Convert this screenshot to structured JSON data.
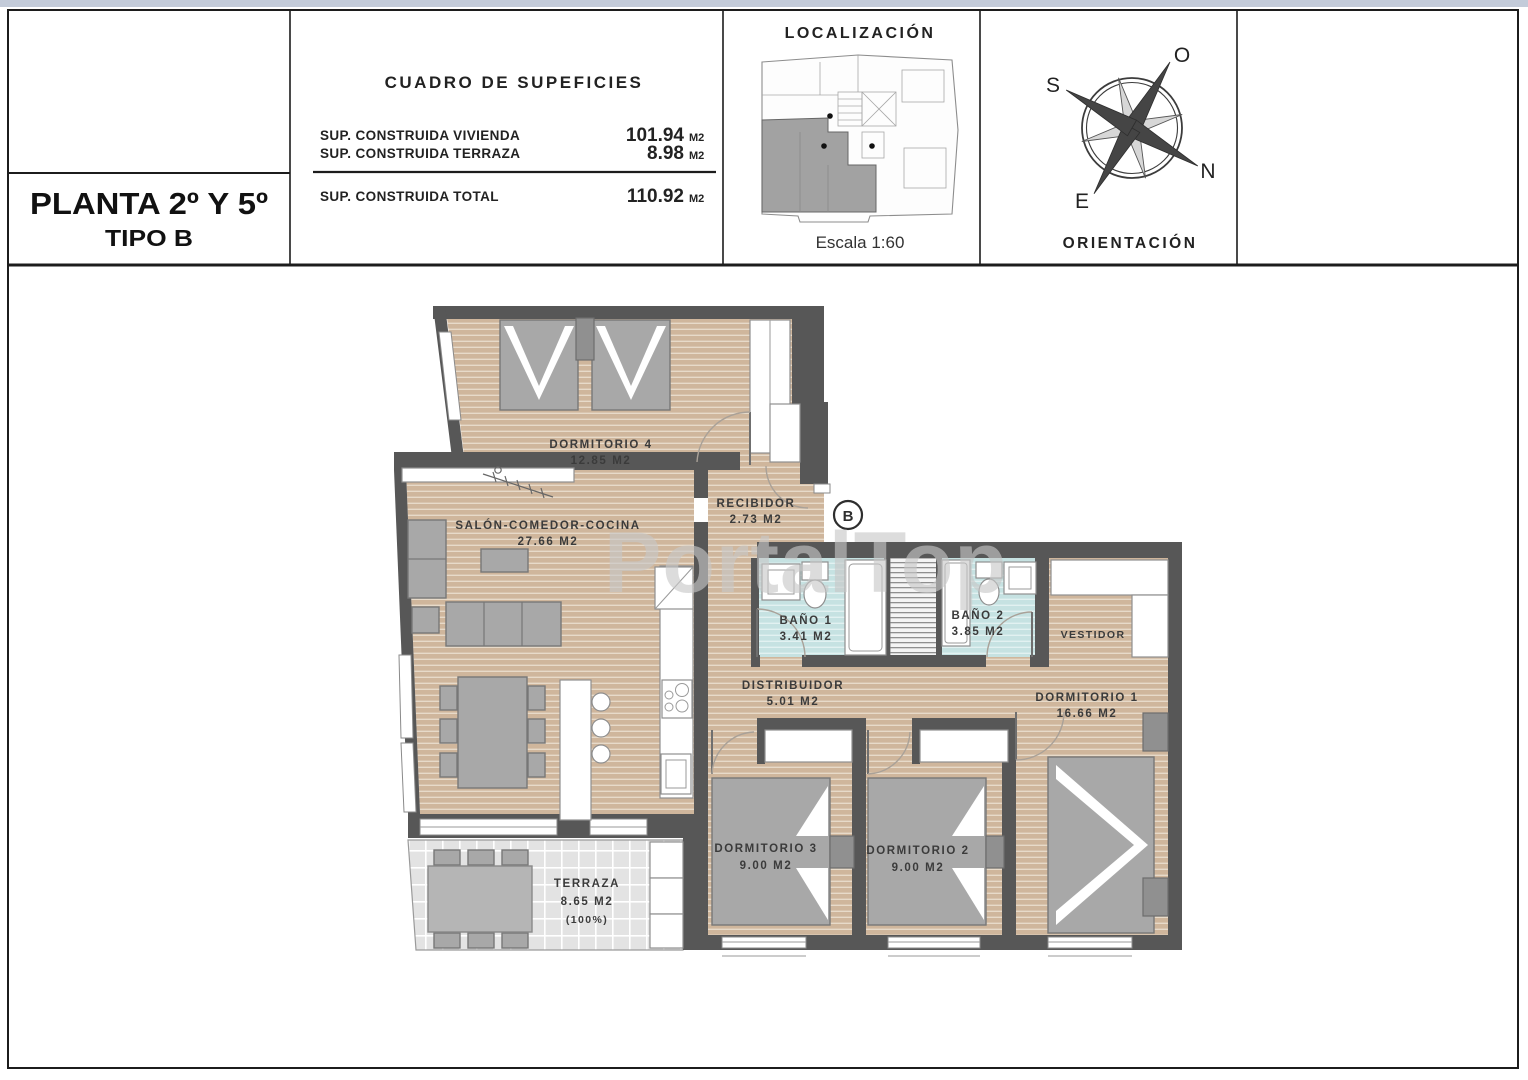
{
  "title_block": {
    "line1": "PLANTA 2º Y 5º",
    "line2": "TIPO B"
  },
  "surface_table": {
    "title": "CUADRO DE SUPEFICIES",
    "rows": [
      {
        "label": "SUP. CONSTRUIDA VIVIENDA",
        "value": "101.94",
        "unit": "M2"
      },
      {
        "label": "SUP. CONSTRUIDA TERRAZA",
        "value": "8.98",
        "unit": "M2"
      }
    ],
    "total_row": {
      "label": "SUP. CONSTRUIDA TOTAL",
      "value": "110.92",
      "unit": "M2"
    }
  },
  "localization_block": {
    "title": "LOCALIZACIÓN",
    "scale": "Escala 1:60"
  },
  "orientation_block": {
    "title": "ORIENTACIÓN",
    "letters": {
      "south": "S",
      "west": "O",
      "north": "N",
      "east": "E"
    }
  },
  "plan": {
    "watermark": "PortalTop",
    "unit_marker": "B",
    "rooms": [
      {
        "name": "DORMITORIO 4",
        "area": "12.85 M2"
      },
      {
        "name": "SALÓN-COMEDOR-COCINA",
        "area": "27.66 M2"
      },
      {
        "name": "RECIBIDOR",
        "area": "2.73 M2"
      },
      {
        "name": "BAÑO 1",
        "area": "3.41 M2"
      },
      {
        "name": "BAÑO 2",
        "area": "3.85 M2"
      },
      {
        "name": "VESTIDOR"
      },
      {
        "name": "DISTRIBUIDOR",
        "area": "5.01 M2"
      },
      {
        "name": "DORMITORIO 1",
        "area": "16.66 M2"
      },
      {
        "name": "DORMITORIO 3",
        "area": "9.00 M2"
      },
      {
        "name": "DORMITORIO 2",
        "area": "9.00 M2"
      },
      {
        "name": "TERRAZA",
        "area": "8.65 M2",
        "note": "(100%)"
      }
    ],
    "colors": {
      "wall": "#575757",
      "wood_floor": "#cfb69c",
      "bathroom_floor": "#c6e2e2",
      "terrace_floor": "#e3e3e3",
      "furniture": "#a8a8a8",
      "top_bar": "#c3cbd9"
    }
  }
}
